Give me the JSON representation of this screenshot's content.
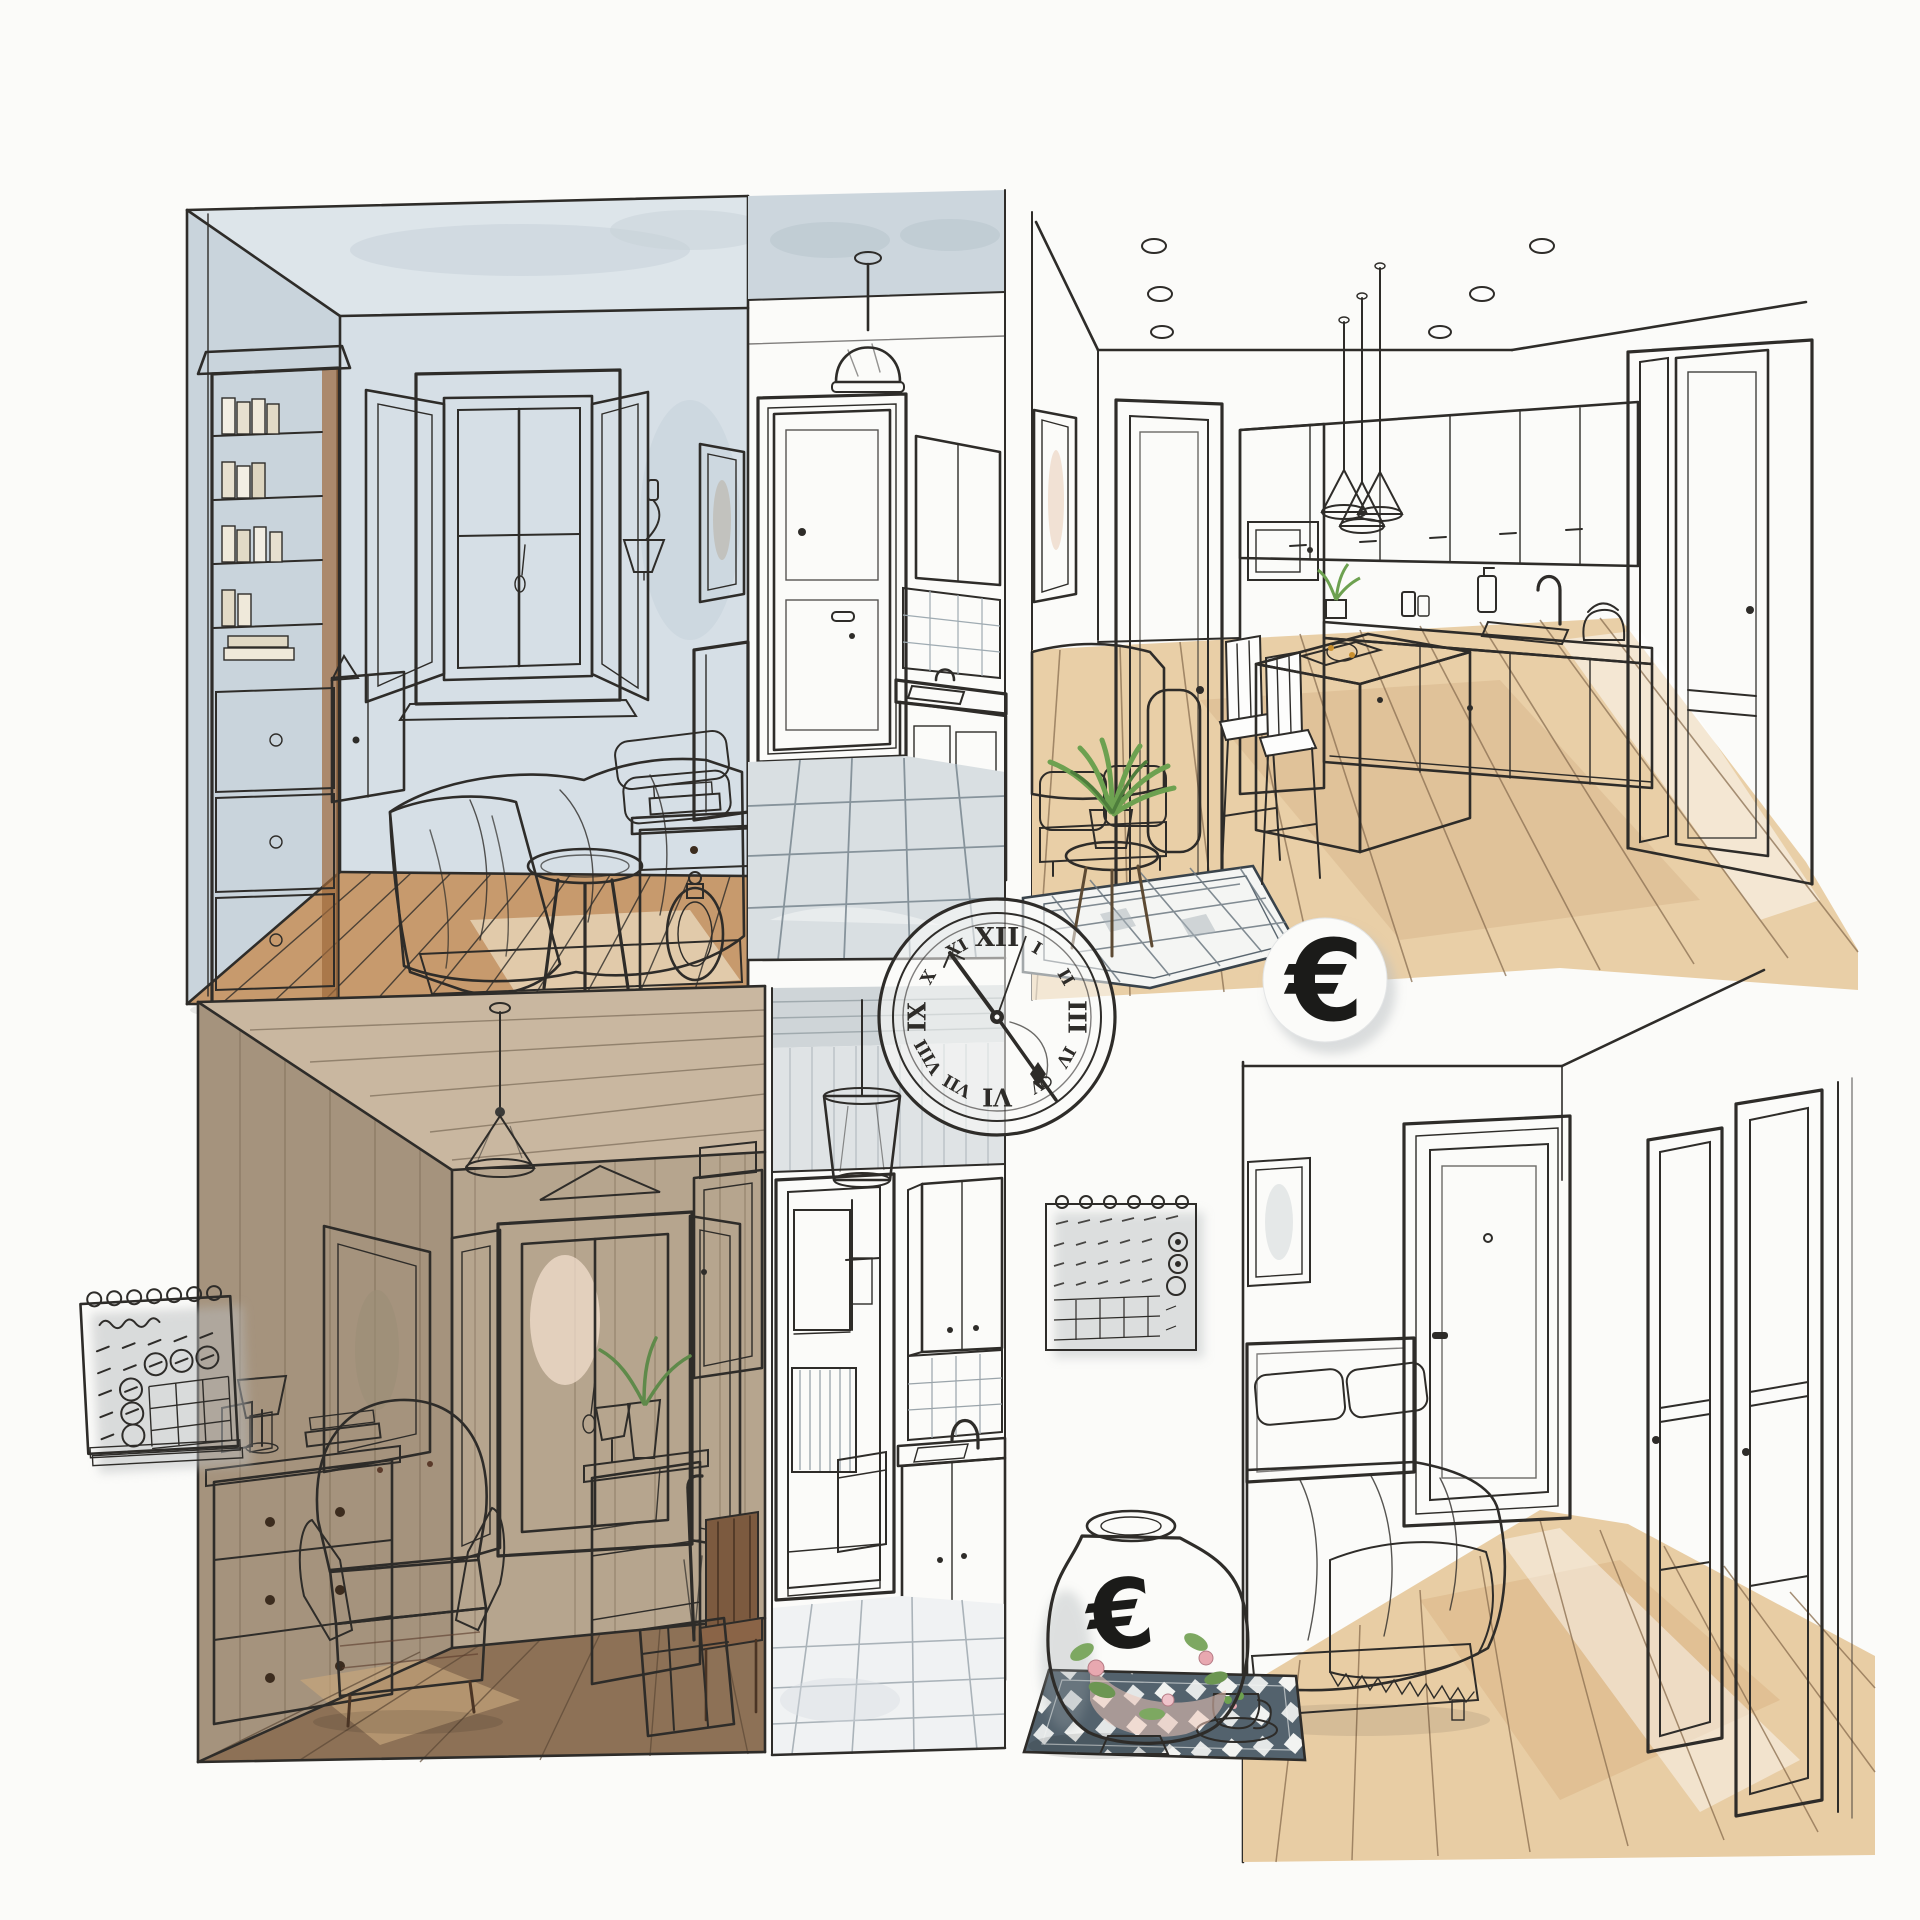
{
  "symbols": {
    "euro_badge": "€",
    "vase_euro": "€",
    "clock_numerals": [
      "I",
      "II",
      "III",
      "IV",
      "V",
      "VI",
      "VII",
      "VIII",
      "IX",
      "X",
      "XI",
      "XII"
    ]
  },
  "palette": {
    "ink": "#2e2c29",
    "paper": "#fbfbf9",
    "wall_blue_grey": "#d6dfe6",
    "wall_taupe": "#b6a58e",
    "wood_shelf": "#c08850",
    "floor_warm": "#c79a6d",
    "floor_light": "#e9cfa7",
    "floor_brown": "#8d7156",
    "blanket_blue": "#b2c1cc",
    "cushion_pink": "#d8a29f",
    "leather_brown": "#8d5f49",
    "plant_green": "#6da150",
    "grey_wash": "#dfe3e5",
    "mat_slate": "#53626d",
    "vase_cream": "#f7f0e1"
  }
}
